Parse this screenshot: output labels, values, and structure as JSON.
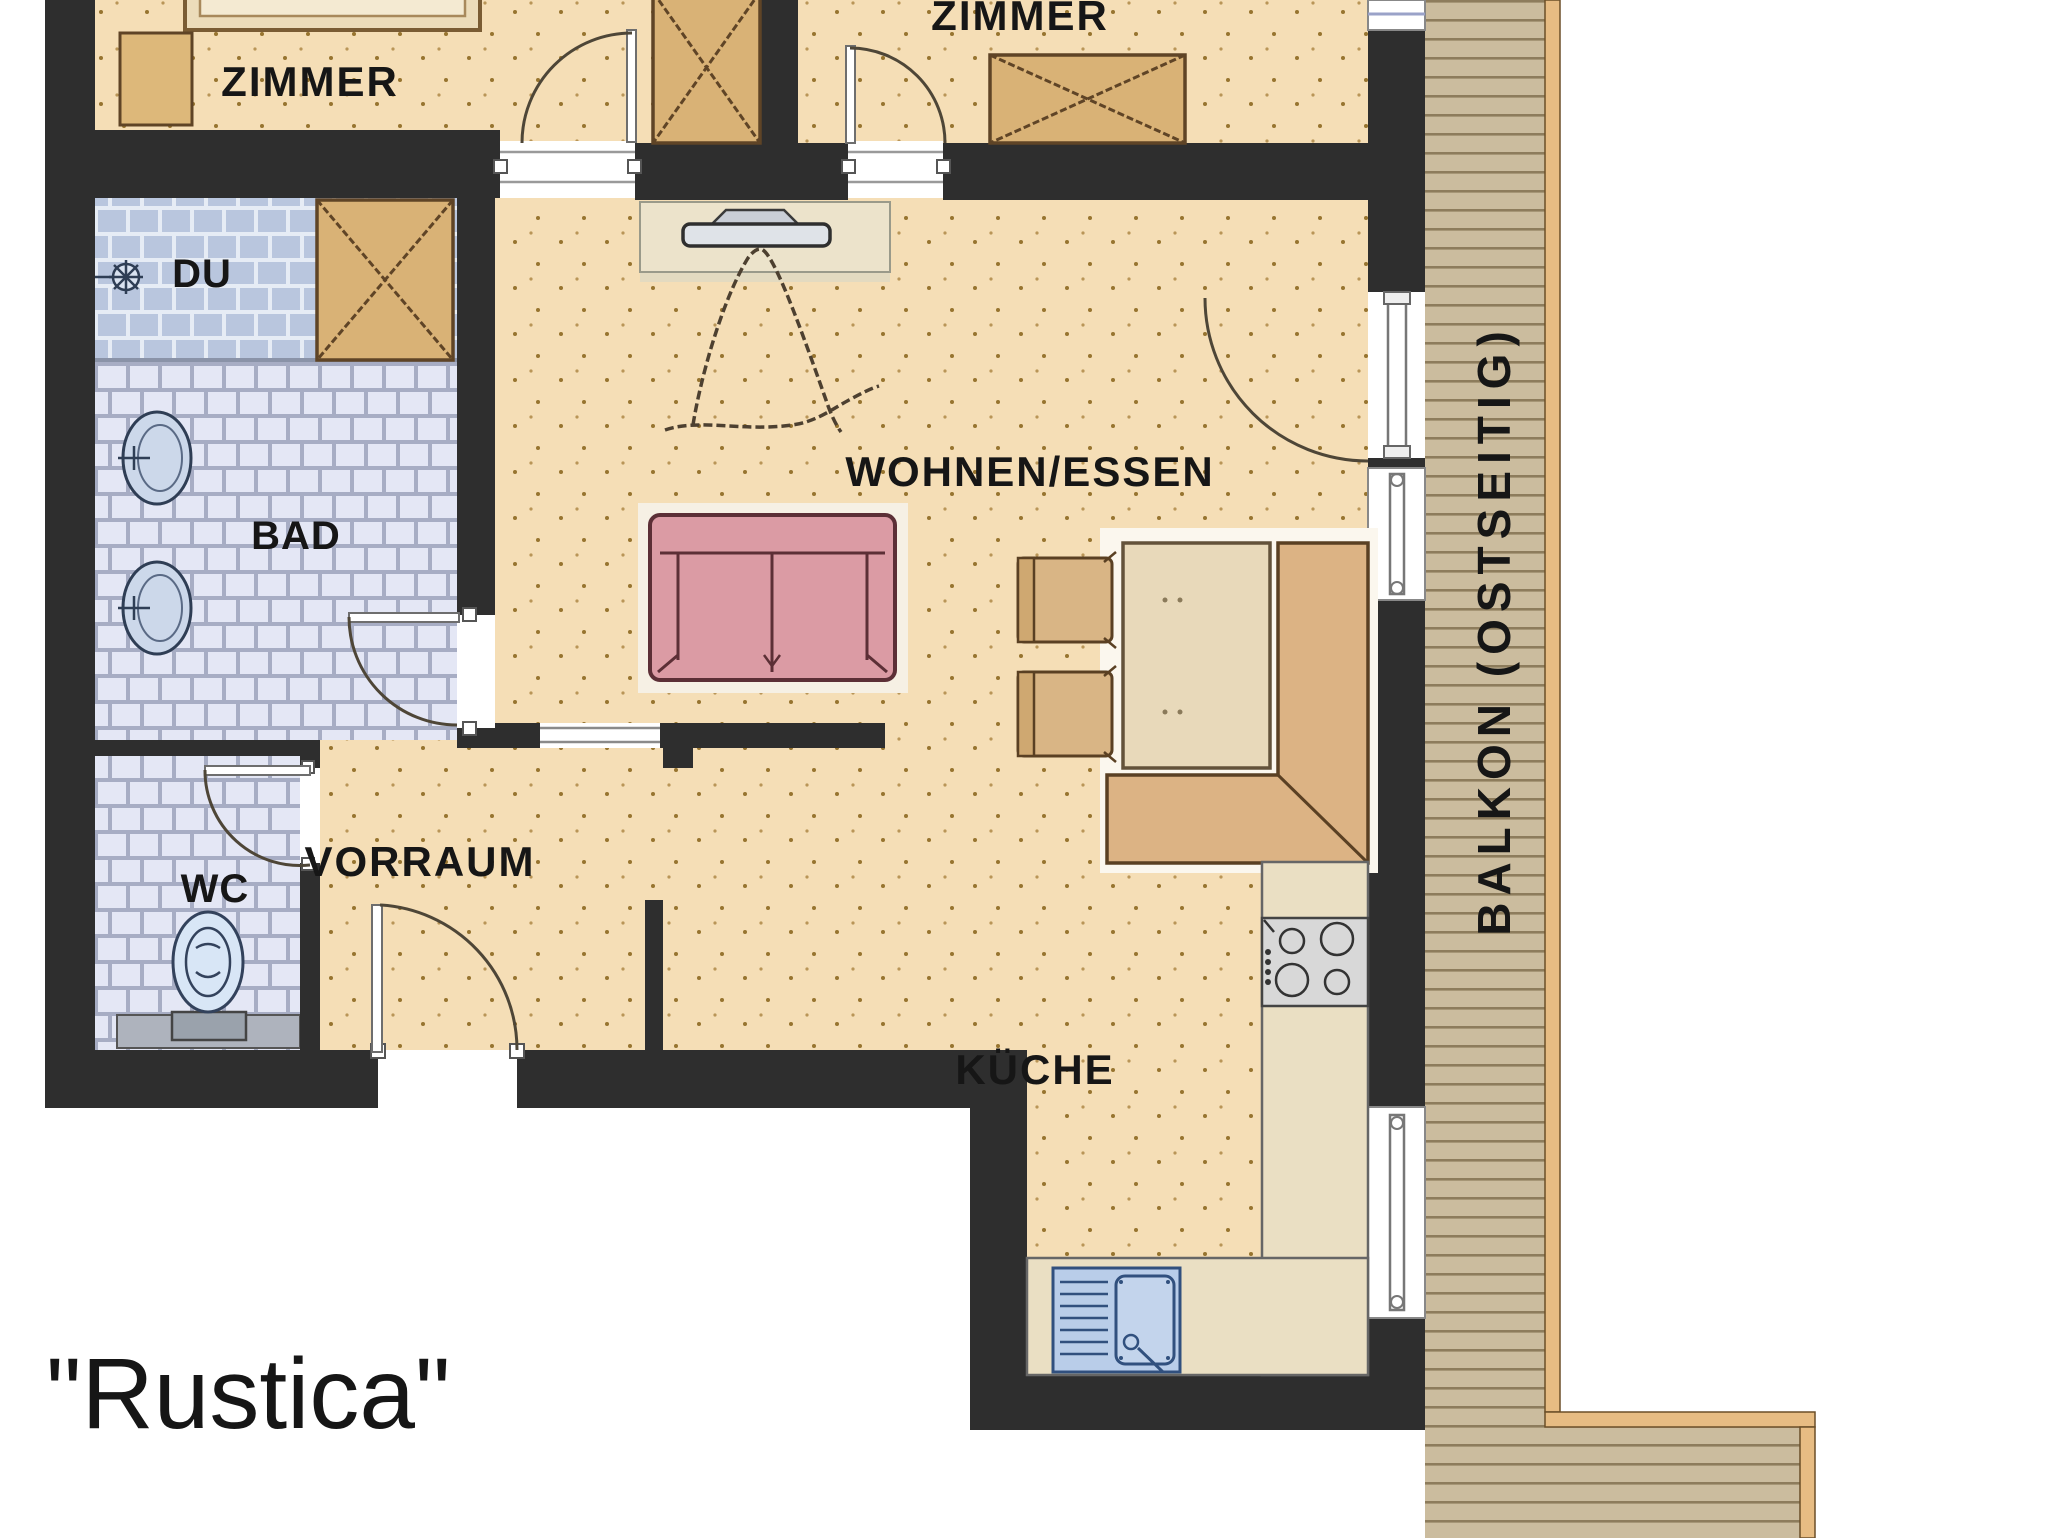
{
  "plan_name": "\"Rustica\"",
  "balcony": {
    "label": "BALKON (OSTSEITIG)"
  },
  "rooms": {
    "bedroom_left": "ZIMMER",
    "bedroom_right": "ZIMMER",
    "living_dining": "WOHNEN/ESSEN",
    "hallway": "VORRAUM",
    "kitchen": "KÜCHE",
    "bathroom": "BAD",
    "shower": "DU",
    "wc": "WC"
  },
  "colors": {
    "wall": "#2e2e2e",
    "floor": "#f5deb6",
    "floor_dot": "#97742f",
    "bath_tile": "#e4e7f5",
    "bath_grout": "#a7adc4",
    "shower_tile": "#b9c6de",
    "wood_furniture": "#ddb87a",
    "wood_outline": "#5f4426",
    "sofa": "#db9ba4",
    "sofa_outline": "#5c2f36",
    "bench": "#dcb384",
    "table": "#e8d9ba",
    "counter": "#eadfc3",
    "balcony_deck": "#cbbc9e",
    "balcony_plank_line": "#8d7c5c",
    "balcony_border": "#e7bc83",
    "sink_blue": "#c3d4ec",
    "stove_gray": "#d8d8d8",
    "door_arc": "#4e4637"
  }
}
